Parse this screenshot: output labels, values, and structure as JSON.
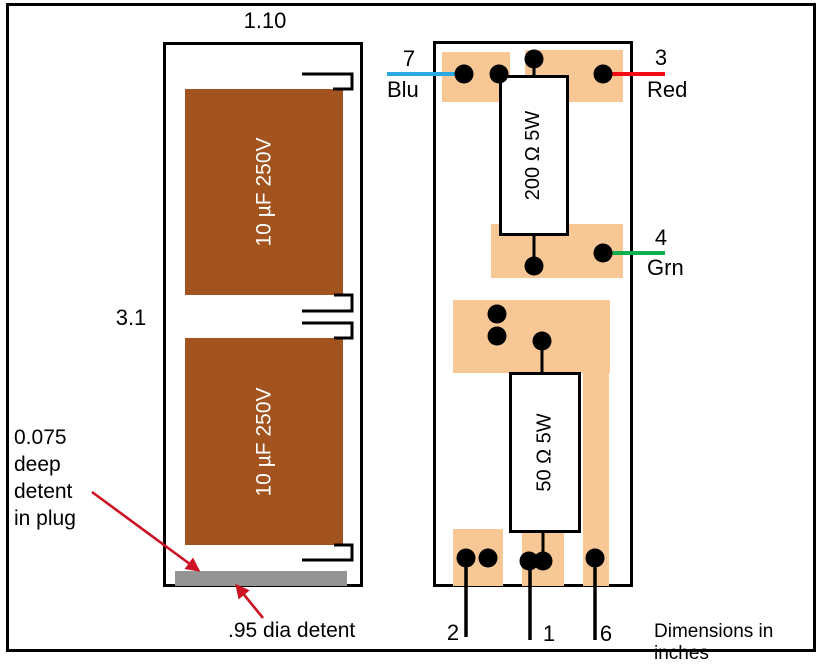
{
  "colors": {
    "capacitor-brown": "#A3541E",
    "pad-peach": "#F7C795",
    "detent-gray": "#949494",
    "wire-blue": "#2BA9E0",
    "wire-red": "#F40B12",
    "wire-green": "#0FAD4D",
    "arrow-red": "#CC1122",
    "line-black": "#000000"
  },
  "left_module": {
    "width_dim": "1.10",
    "height_dim": "3.1",
    "capacitor_top_label": "10 µF 250V",
    "capacitor_bottom_label": "10 µF 250V",
    "detent_note_lines": [
      "0.075",
      "deep",
      "detent",
      "in plug"
    ],
    "detent_dia_label": ".95 dia detent"
  },
  "right_board": {
    "resistor_top_label": "200 Ω 5W",
    "resistor_bottom_label": "50 Ω 5W",
    "wire_labels": {
      "blu_pin": "7",
      "blu_name": "Blu",
      "red_pin": "3",
      "red_name": "Red",
      "grn_pin": "4",
      "grn_name": "Grn"
    },
    "pin_labels": {
      "pin2": "2",
      "pin1": "1",
      "pin6": "6"
    }
  },
  "footer": {
    "units_note": "Dimensions in inches"
  }
}
